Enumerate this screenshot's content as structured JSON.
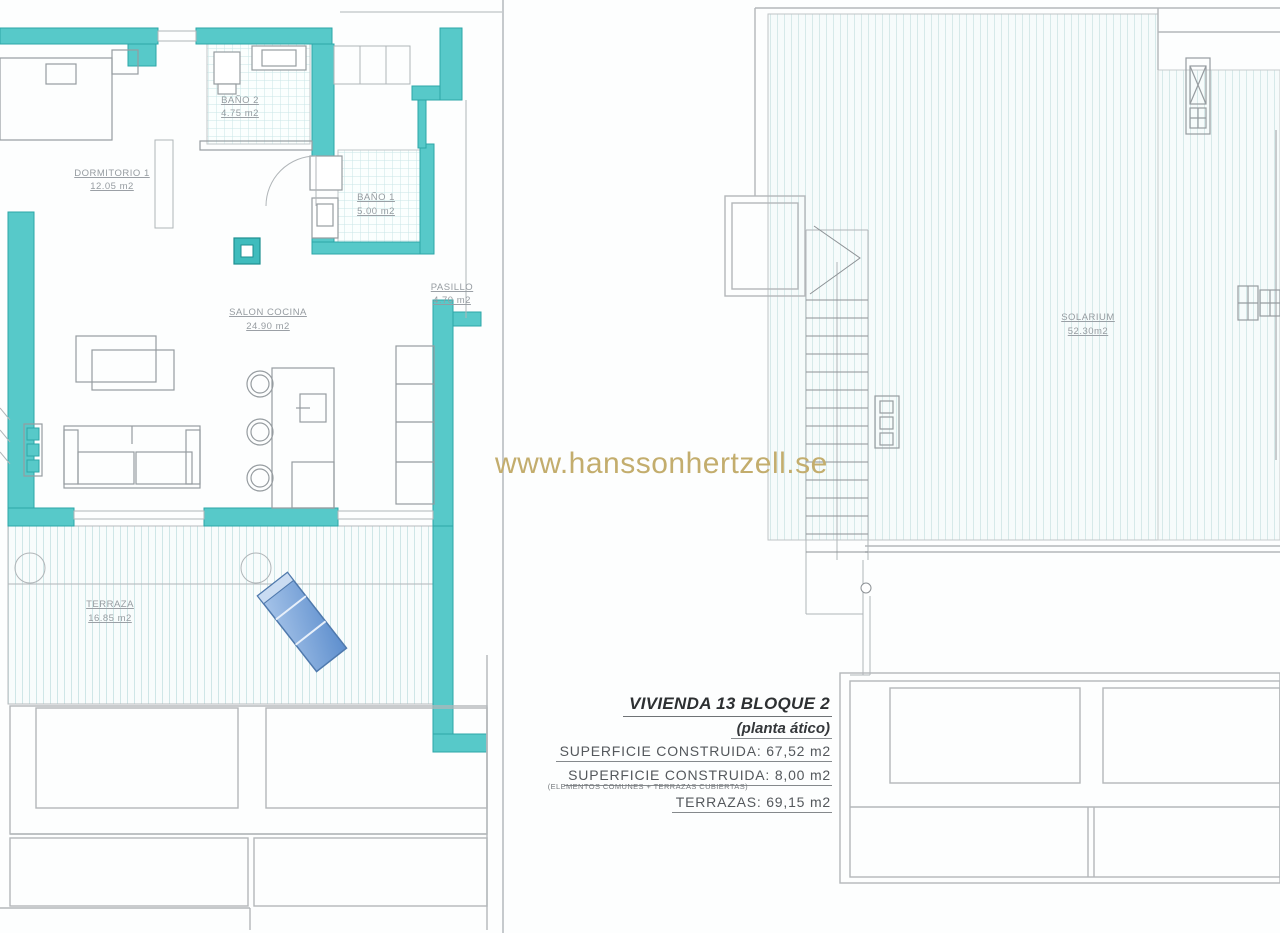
{
  "watermark": {
    "text": "www.hanssonhertzell.se",
    "color": "#c3ad6d"
  },
  "left_plan": {
    "name": "apartment floor plan",
    "rooms": [
      {
        "id": "dormitorio-1",
        "label": "DORMITORIO 1",
        "area": "12.05 m2"
      },
      {
        "id": "bano-2",
        "label": "BAÑO 2",
        "area": "4.75 m2"
      },
      {
        "id": "bano-1",
        "label": "BAÑO 1",
        "area": "5.00 m2"
      },
      {
        "id": "salon-cocina",
        "label": "SALON COCINA",
        "area": "24.90 m2"
      },
      {
        "id": "pasillo",
        "label": "PASILLO",
        "area": "4.70 m2"
      },
      {
        "id": "terraza",
        "label": "TERRAZA",
        "area": "16.85 m2"
      }
    ]
  },
  "right_plan": {
    "name": "solarium roof plan",
    "rooms": [
      {
        "id": "solarium",
        "label": "SOLARIUM",
        "area": "52.30m2"
      }
    ]
  },
  "info_block": {
    "title": "VIVIENDA 13 BLOQUE 2",
    "subtitle": "(planta ático)",
    "superficie_1": "SUPERFICIE CONSTRUIDA: 67,52 m2",
    "superficie_2": "SUPERFICIE CONSTRUIDA: 8,00 m2",
    "note": "(ELEMENTOS COMUNES + TERRAZAS CUBIERTAS)",
    "terrazas": "TERRAZAS: 69,15 m2"
  },
  "colors": {
    "wall": "#57c9c9",
    "wall_edge": "#2ca6a8",
    "drawing_line": "#969ca0",
    "tile": "#c8e6e7",
    "deck_stripe": "#d3e8e9",
    "lounger_blue": "#7ba6d8",
    "watermark_gold": "#c3ad6d"
  }
}
